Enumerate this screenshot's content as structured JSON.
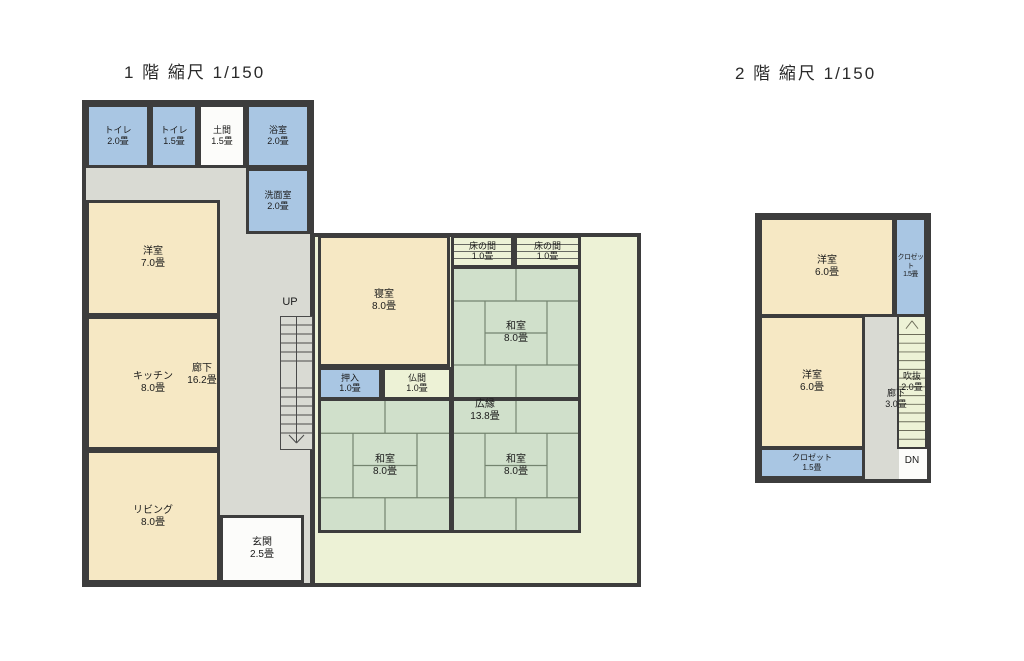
{
  "document": {
    "type": "floor-plan-scan",
    "scale": "1/150"
  },
  "colors": {
    "wall": "#3d3d3d",
    "room_blue": "#a9c6e3",
    "room_cream": "#f6e8c4",
    "room_green": "#d0e0cb",
    "room_pale": "#edf2d6",
    "corridor_gray": "#d9dad3",
    "room_white": "#fcfcfa",
    "ink": "#1b1b1b"
  },
  "floor1": {
    "title": "1 階 縮尺 1/150",
    "stairs_direction_label": "UP",
    "rooms": {
      "toilet1": {
        "name": "トイレ",
        "size": "2.0畳"
      },
      "toilet2": {
        "name": "トイレ",
        "size": "1.5畳"
      },
      "doma": {
        "name": "土間",
        "size": "1.5畳"
      },
      "bath": {
        "name": "浴室",
        "size": "2.0畳"
      },
      "senmen": {
        "name": "洗面室",
        "size": "2.0畳"
      },
      "yoshitsu7": {
        "name": "洋室",
        "size": "7.0畳"
      },
      "kitchen": {
        "name": "キッチン",
        "size": "8.0畳"
      },
      "rouka": {
        "name": "廊下",
        "size": "16.2畳"
      },
      "living": {
        "name": "リビング",
        "size": "8.0畳"
      },
      "genkan": {
        "name": "玄関",
        "size": "2.5畳"
      },
      "shinshitsu": {
        "name": "寝室",
        "size": "8.0畳"
      },
      "oshiire": {
        "name": "押入",
        "size": "1.0畳"
      },
      "butsuma": {
        "name": "仏間",
        "size": "1.0畳"
      },
      "tokonoma1": {
        "name": "床の間",
        "size": "1.0畳"
      },
      "tokonoma2": {
        "name": "床の間",
        "size": "1.0畳"
      },
      "washitsu_tr": {
        "name": "和室",
        "size": "8.0畳"
      },
      "washitsu_bl": {
        "name": "和室",
        "size": "8.0畳"
      },
      "washitsu_br": {
        "name": "和室",
        "size": "8.0畳"
      },
      "hiroen": {
        "name": "広縁",
        "size": "13.8畳"
      }
    }
  },
  "floor2": {
    "title": "2 階 縮尺 1/150",
    "stairs_direction_label": "DN",
    "rooms": {
      "yoshitsu_a": {
        "name": "洋室",
        "size": "6.0畳"
      },
      "closet_a": {
        "name": "クロゼット",
        "size": "1.5畳"
      },
      "yoshitsu_b": {
        "name": "洋室",
        "size": "6.0畳"
      },
      "fukinuke": {
        "name": "吹抜",
        "size": "2.0畳"
      },
      "rouka": {
        "name": "廊下",
        "size": "3.0畳"
      },
      "closet_b": {
        "name": "クロゼット",
        "size": "1.5畳"
      }
    }
  }
}
